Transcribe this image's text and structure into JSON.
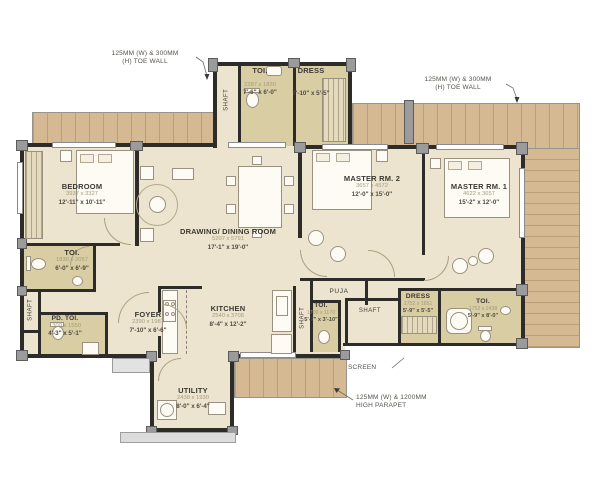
{
  "annotations": {
    "toe_wall_left": "125MM (W) & 300MM\n(H) TOE WALL",
    "toe_wall_right": "125MM (W) & 300MM\n(H) TOE WALL",
    "screen": "SCREEN",
    "parapet": "125MM (W) & 1200MM\nHIGH PARAPET"
  },
  "rooms": {
    "toi_top": {
      "name": "TOI.",
      "mm": "2287 x 1830",
      "ft": "7'-6\" x 6'-0\""
    },
    "dress_top": {
      "name": "DRESS",
      "ft": "7'-10\" x 5'-5\""
    },
    "bedroom": {
      "name": "BEDROOM",
      "mm": "3937 x 3327",
      "ft": "12'-11\" x 10'-11\""
    },
    "master2": {
      "name": "MASTER RM. 2",
      "mm": "3657 x 4572",
      "ft": "12'-0\" x 15'-0\""
    },
    "master1": {
      "name": "MASTER RM. 1",
      "mm": "4622 x 3657",
      "ft": "15'-2\" x 12'-0\""
    },
    "drawing": {
      "name": "DRAWING/ DINING ROOM",
      "mm": "5207 x 5791",
      "ft": "17'-1\" x 19'-0\""
    },
    "toi_left": {
      "name": "TOI.",
      "mm": "1830 x 2057",
      "ft": "6'-0\" x 6'-9\""
    },
    "pd_toi": {
      "name": "PD. TOI.",
      "mm": "1300 x 1550",
      "ft": "4'-3\" x 5'-1\""
    },
    "foyer": {
      "name": "FOYER",
      "mm": "2390 x 1981",
      "ft": "7'-10\" x 6'-6\""
    },
    "kitchen": {
      "name": "KITCHEN",
      "mm": "2540 x 3708",
      "ft": "8'-4\" x 12'-2\""
    },
    "puja": {
      "name": "PUJA"
    },
    "toi_mid": {
      "name": "TOI.",
      "mm": "1700 x 1170",
      "ft": "5'-7\" x 3'-10\""
    },
    "dress_right": {
      "name": "DRESS",
      "mm": "1752 x 1651",
      "ft": "5'-9\" x 5'-5\""
    },
    "toi_right": {
      "name": "TOI.",
      "mm": "1752 x 2438",
      "ft": "5'-9\" x 8'-0\""
    },
    "utility": {
      "name": "UTILITY",
      "mm": "2438 x 1930",
      "ft": "8'-0\" x 6'-4\""
    },
    "shaft": {
      "name": "SHAFT"
    }
  },
  "colors": {
    "deck": "#d5b993",
    "floor": "#ece4cf",
    "wet_floor": "#d9cda4",
    "wall": "#2e2c28",
    "column": "#9b9b9b"
  }
}
